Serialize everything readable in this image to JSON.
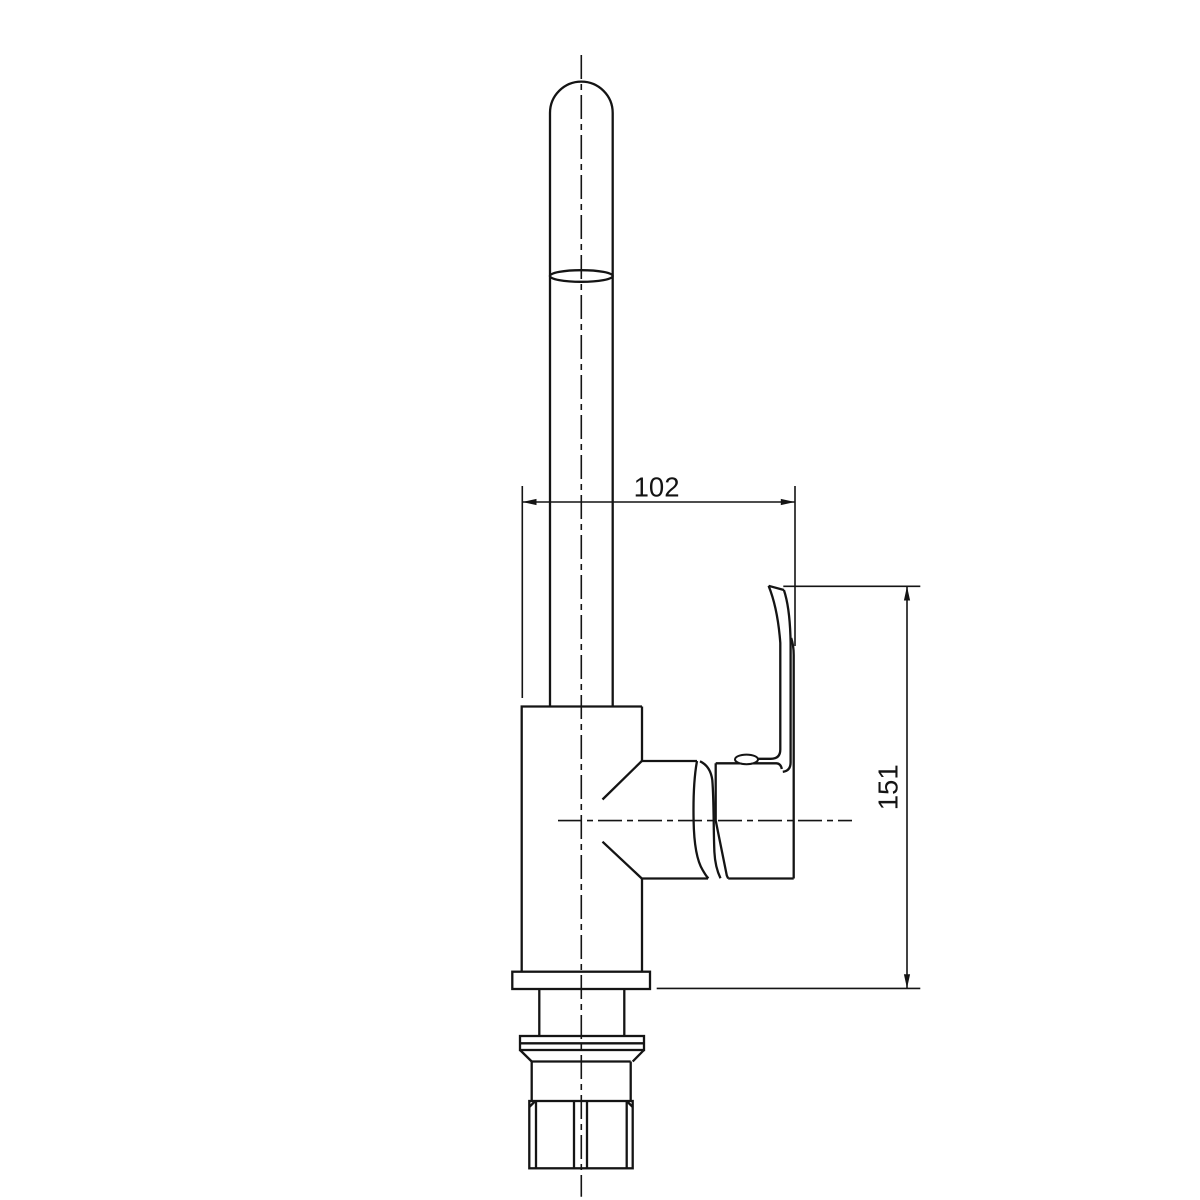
{
  "drawing": {
    "kind": "technical-dimension-drawing",
    "subject": "single-lever-kitchen-faucet-side-elevation",
    "background_color": "#ffffff",
    "line_color": "#141414"
  },
  "dimensions": {
    "width": {
      "value": "102",
      "orientation": "horizontal"
    },
    "height": {
      "value": "151",
      "orientation": "vertical"
    }
  }
}
